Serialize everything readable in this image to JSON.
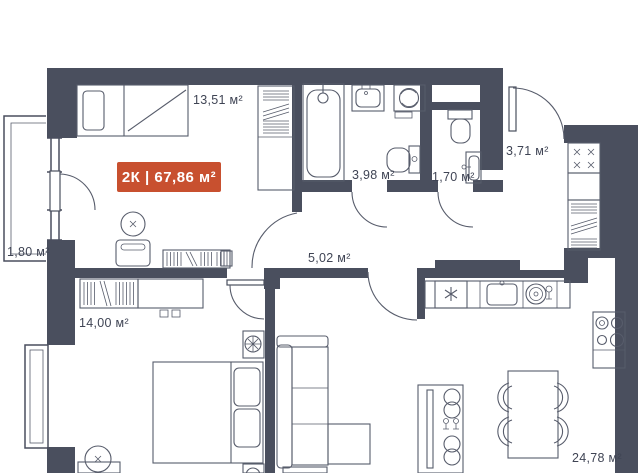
{
  "floor_plan": {
    "badge": {
      "text": "2К | 67,86 м²"
    },
    "rooms": [
      {
        "name": "bedroom-1",
        "area": "13,51 м²"
      },
      {
        "name": "bathroom",
        "area": "3,98 м²"
      },
      {
        "name": "wc",
        "area": "1,70 м²"
      },
      {
        "name": "entry-hall",
        "area": "3,71 м²"
      },
      {
        "name": "corridor",
        "area": "5,02 м²"
      },
      {
        "name": "balcony",
        "area": "1,80 м²"
      },
      {
        "name": "bedroom-2",
        "area": "14,00 м²"
      },
      {
        "name": "kitchen-living-room",
        "area": "24,78 м²"
      }
    ],
    "colors": {
      "background": "#ffffff",
      "wall": "#4a4f5e",
      "furniture_line": "#575c6b",
      "label_text": "#3f4454",
      "badge_bg": "#c8502f",
      "badge_text": "#ffffff"
    }
  }
}
